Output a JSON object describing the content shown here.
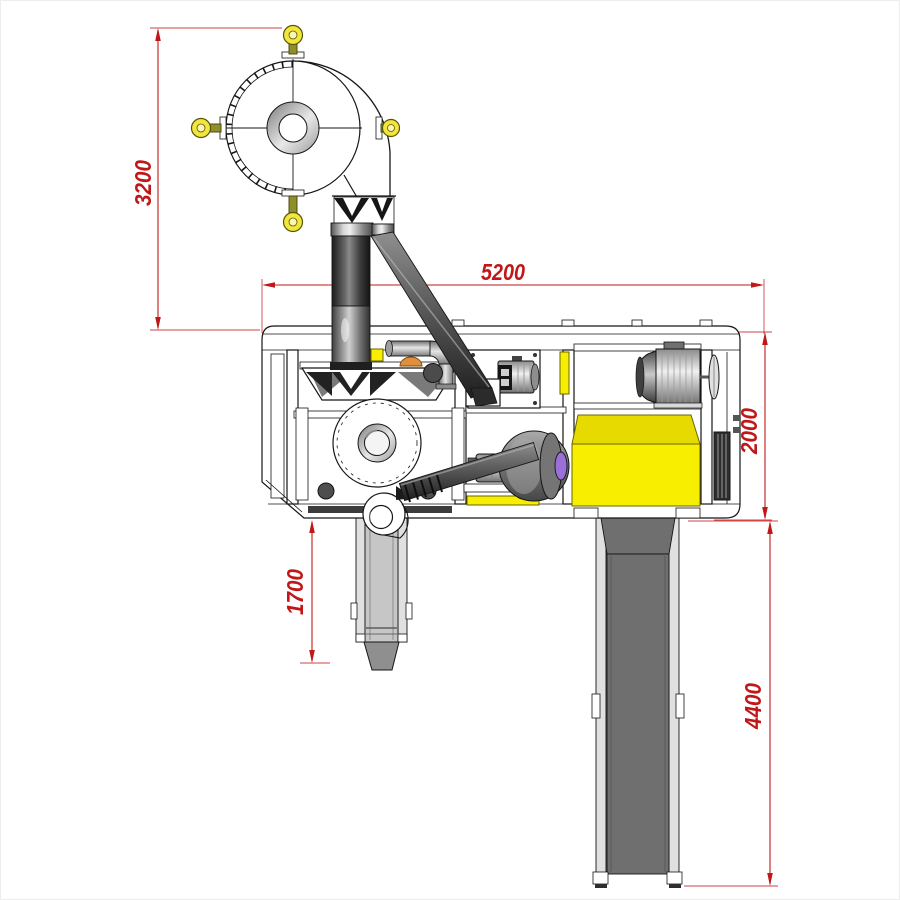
{
  "dimensions": {
    "cyclone_height": "3200",
    "overall_length": "5200",
    "frame_height": "2000",
    "chute_drop": "1700",
    "conveyor_length": "4400"
  },
  "colors": {
    "dimension_red": "#c01818",
    "machine_yellow": "#f7ee00",
    "guard_yellow_top": "#e6da00",
    "eyebolt_yellow": "#f2e63c",
    "eyebolt_olive": "#8f8f2a",
    "purple_coupling": "#9a6fd8",
    "orange_dome": "#e08f3c",
    "belt_gray": "#6f6f6f",
    "rail_gray": "#e0e0e0",
    "chute_gray": "#c6c6c6",
    "duct_dark": "#2f2f2f",
    "outline_black": "#161616",
    "background": "#ffffff"
  }
}
